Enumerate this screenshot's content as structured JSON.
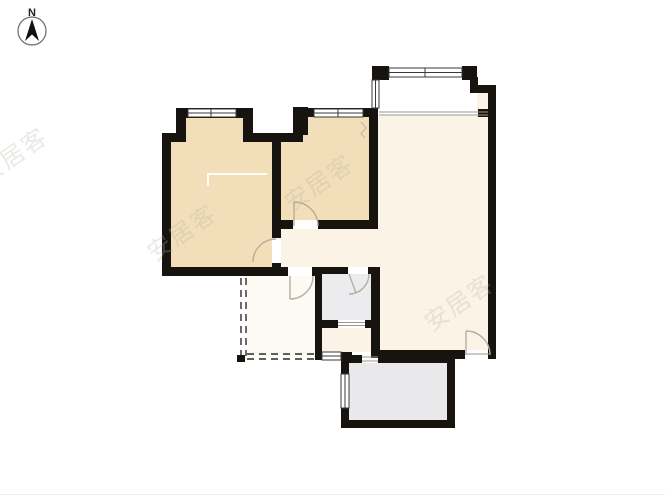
{
  "compass": {
    "label": "N"
  },
  "watermark": {
    "text": "安居客"
  },
  "colors": {
    "background": "#ffffff",
    "wall": "#17130e",
    "bedroom_fill": "#f2deb8",
    "living_fill": "#faf3e6",
    "kitchen_fill": "#fcfaf3",
    "bath_fill": "#ececef",
    "balcony_fill": "#e9e9ec",
    "door_arc": "#b6ad9e",
    "window_line": "#3a3a3a",
    "dash_line": "#2a2a2a",
    "watermark_color": "#b9b2a6"
  }
}
